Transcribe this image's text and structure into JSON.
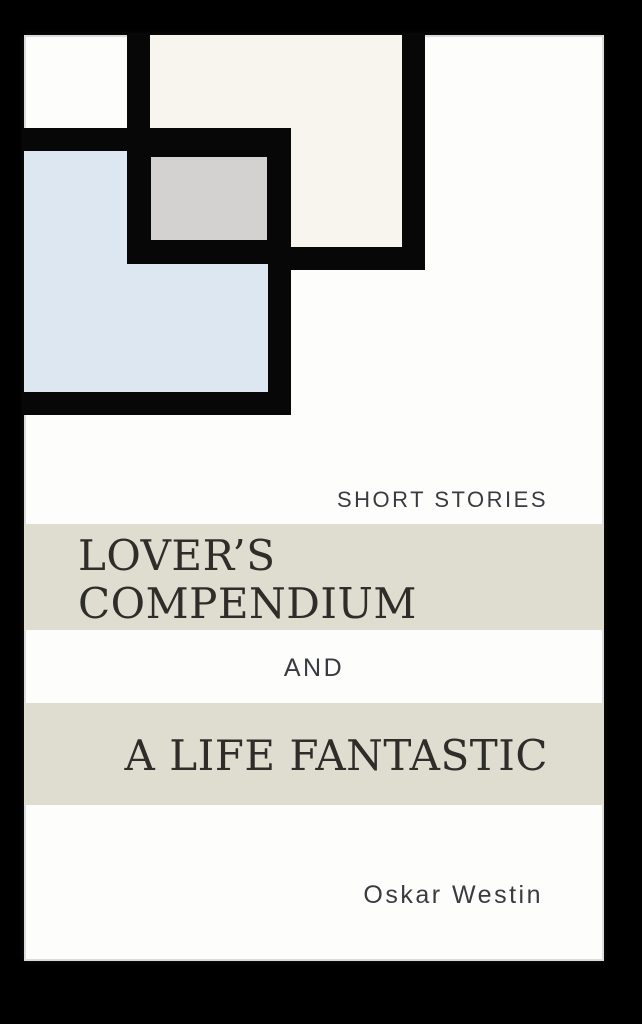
{
  "page": {
    "background_color": "#000000"
  },
  "cover": {
    "background_color": "#fdfdfc",
    "edge_color": "#c6c6c6",
    "subtitle": "SHORT STORIES",
    "title_lines": [
      "LOVER’S",
      "COMPENDIUM"
    ],
    "connector": "AND",
    "second_title": "A LIFE FANTASTIC",
    "author": "Oskar Westin",
    "band_color": "#deddd0",
    "serif_text_color": "#2e2d2a",
    "sans_text_color": "#393b40"
  },
  "art": {
    "outline_color": "#070707",
    "squares": [
      {
        "name": "cream-square",
        "fill": "#f7f5ee"
      },
      {
        "name": "blue-square",
        "fill": "#dde7f2"
      },
      {
        "name": "gray-square",
        "fill": "#d3d2d0"
      }
    ]
  }
}
